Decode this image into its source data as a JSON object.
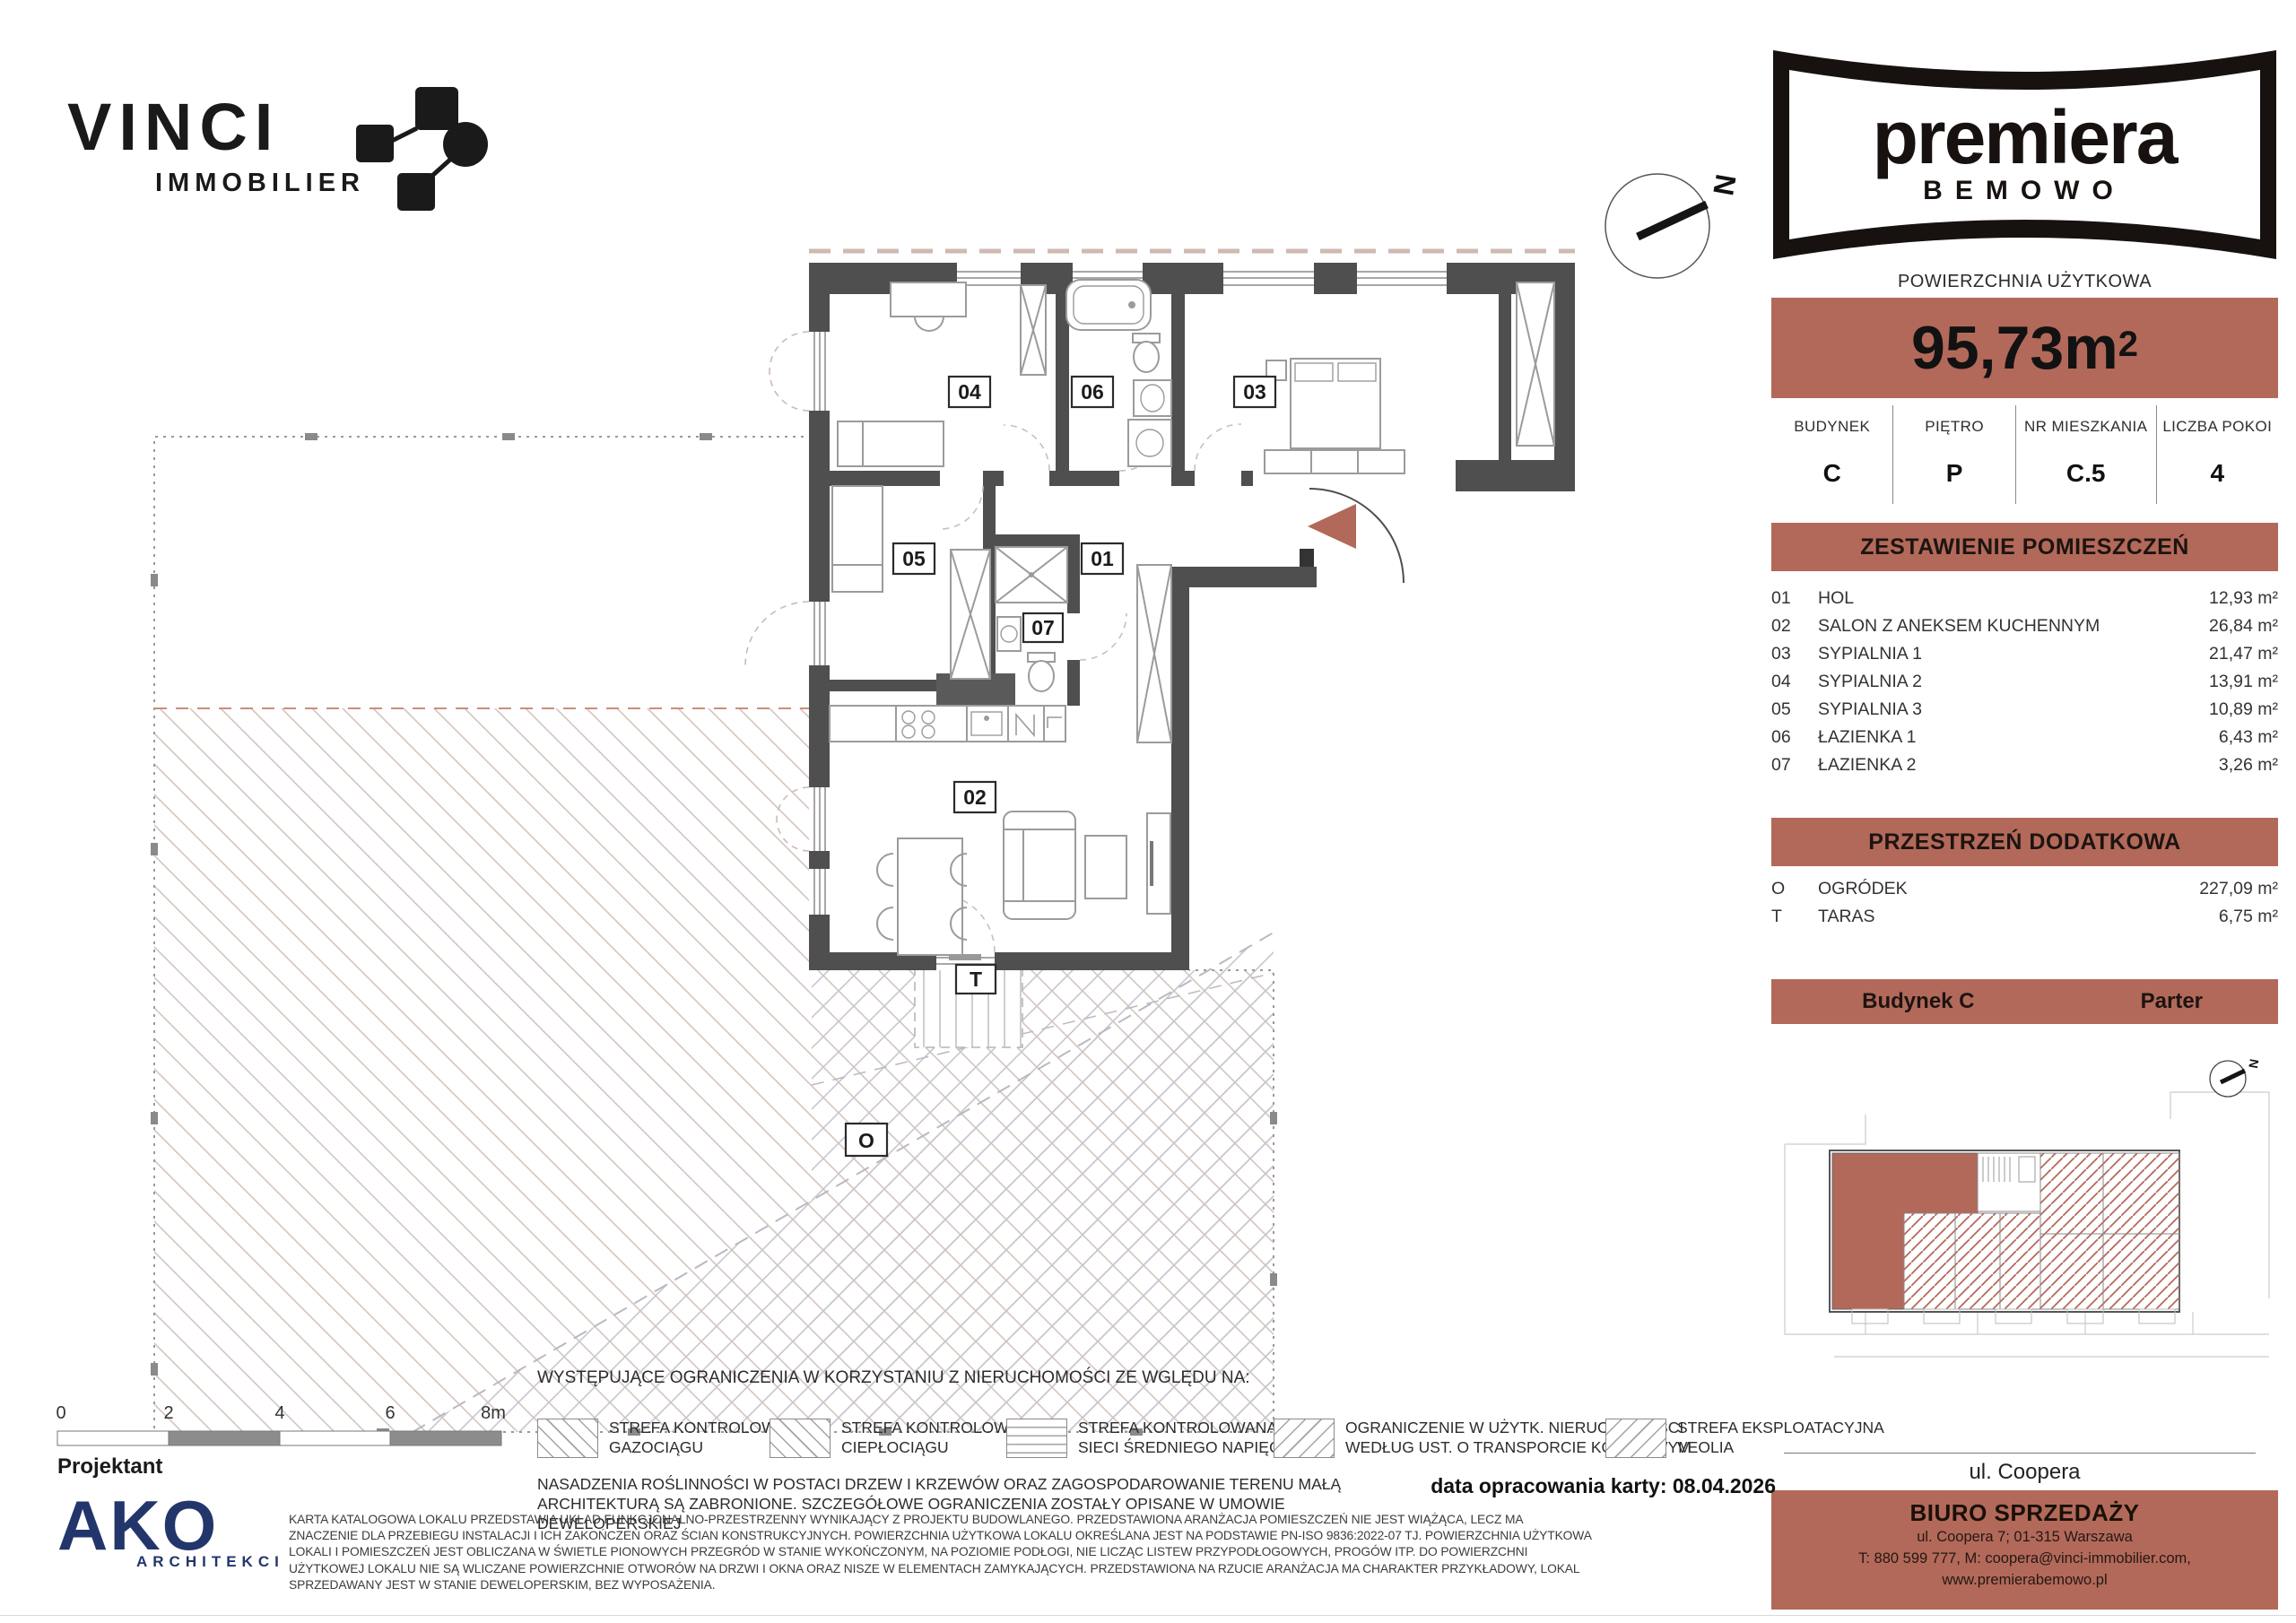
{
  "colors": {
    "accent": "#b2695a",
    "wall": "#4f4f4f",
    "ako_navy": "#23366b"
  },
  "vinci_logo": {
    "name": "VINCI",
    "sub": "IMMOBILIER"
  },
  "premiera_logo": {
    "name": "premiera",
    "sub": "BEMOWO"
  },
  "unit_header": {
    "area_label": "POWIERZCHNIA UŻYTKOWA",
    "area_value": "95,73m",
    "area_sup": "2",
    "fields": [
      {
        "label": "BUDYNEK",
        "value": "C"
      },
      {
        "label": "PIĘTRO",
        "value": "P"
      },
      {
        "label": "NR MIESZKANIA",
        "value": "C.5"
      },
      {
        "label": "LICZBA POKOI",
        "value": "4"
      }
    ]
  },
  "room_table": {
    "title": "ZESTAWIENIE POMIESZCZEŃ",
    "rows": [
      {
        "no": "01",
        "name": "HOL",
        "area": "12,93 m²"
      },
      {
        "no": "02",
        "name": "SALON Z ANEKSEM KUCHENNYM",
        "area": "26,84 m²"
      },
      {
        "no": "03",
        "name": "SYPIALNIA 1",
        "area": "21,47 m²"
      },
      {
        "no": "04",
        "name": "SYPIALNIA 2",
        "area": "13,91 m²"
      },
      {
        "no": "05",
        "name": "SYPIALNIA 3",
        "area": "10,89 m²"
      },
      {
        "no": "06",
        "name": "ŁAZIENKA 1",
        "area": "6,43 m²"
      },
      {
        "no": "07",
        "name": "ŁAZIENKA 2",
        "area": "3,26 m²"
      }
    ]
  },
  "extra_table": {
    "title": "PRZESTRZEŃ DODATKOWA",
    "rows": [
      {
        "no": "O",
        "name": "OGRÓDEK",
        "area": "227,09 m²"
      },
      {
        "no": "T",
        "name": "TARAS",
        "area": "6,75 m²"
      }
    ]
  },
  "location_bar": {
    "building": "Budynek  C",
    "floor": "Parter"
  },
  "street_label": "ul. Coopera",
  "sales_office": {
    "title": "BIURO SPRZEDAŻY",
    "address": "ul. Coopera 7; 01-315 Warszawa",
    "contact": "T: 880 599 777, M: coopera@vinci-immobilier.com,",
    "website": "www.premierabemowo.pl"
  },
  "plan_labels": {
    "hol": "01",
    "salon": "02",
    "sypialnia1": "03",
    "sypialnia2": "04",
    "sypialnia3": "05",
    "lazienka1": "06",
    "lazienka2": "07",
    "taras": "T",
    "ogrodek": "O",
    "compass": "N"
  },
  "scale_bar": {
    "t0": "0",
    "t2": "2",
    "t4": "4",
    "t6": "6",
    "t8": "8m"
  },
  "designer": {
    "label": "Projektant",
    "logo_name": "AKO",
    "logo_sub": "ARCHITEKCI"
  },
  "legend": {
    "intro": "WYSTĘPUJĄCE OGRANICZENIA W KORZYSTANIU Z NIERUCHOMOŚCI ZE WGLĘDU NA:",
    "items": [
      {
        "line1": "STREFA KONTROLOWANA",
        "line2": "GAZOCIĄGU"
      },
      {
        "line1": "STREFA KONTROLOWANA",
        "line2": "CIEPŁOCIĄGU"
      },
      {
        "line1": "STREFA KONTROLOWANA",
        "line2": "SIECI ŚREDNIEGO NAPIĘCIA"
      },
      {
        "line1": "OGRANICZENIE W UŻYTK. NIERUCHOMOŚCI",
        "line2": "WEDŁUG UST. O TRANSPORCIE KOLEJOWYM"
      },
      {
        "line1": "STREFA EKSPLOATACYJNA",
        "line2": "VEOLIA"
      }
    ],
    "note": "NASADZENIA ROŚLINNOŚCI W POSTACI DRZEW I KRZEWÓW ORAZ ZAGOSPODAROWANIE TERENU MAŁĄ ARCHITEKTURĄ SĄ ZABRONIONE. SZCZEGÓŁOWE OGRANICZENIA ZOSTAŁY OPISANE W UMOWIE DEWELOPERSKIEJ"
  },
  "date_note": "data opracowania karty: 08.04.2026",
  "disclaimer": "KARTA KATALOGOWA LOKALU PRZEDSTAWIA UKŁAD FUNKCJONALNO-PRZESTRZENNY WYNIKAJĄCY Z PROJEKTU BUDOWLANEGO. PRZEDSTAWIONA ARANŻACJA POMIESZCZEŃ NIE JEST WIĄŻĄCA, LECZ MA ZNACZENIE DLA PRZEBIEGU INSTALACJI I ICH ZAKOŃCZEŃ ORAZ ŚCIAN KONSTRUKCYJNYCH. POWIERZCHNIA UŻYTKOWA LOKALU OKREŚLANA JEST NA PODSTAWIE PN-ISO 9836:2022-07 TJ. POWIERZCHNIA UŻYTKOWA LOKALI I POMIESZCZEŃ JEST OBLICZANA W ŚWIETLE PIONOWYCH PRZEGRÓD W STANIE WYKOŃCZONYM, NA POZIOMIE PODŁOGI, NIE LICZĄC LISTEW PRZYPODŁOGOWYCH, PROGÓW ITP. DO POWIERZCHNI UŻYTKOWEJ LOKALU NIE SĄ WLICZANE POWIERZCHNIE OTWORÓW NA DRZWI I OKNA ORAZ NISZE W ELEMENTACH ZAMYKAJĄCYCH. PRZEDSTAWIONA NA RZUCIE ARANŻACJA MA CHARAKTER PRZYKŁADOWY, LOKAL SPRZEDAWANY JEST W STANIE DEWELOPERSKIM, BEZ WYPOSAŻENIA."
}
